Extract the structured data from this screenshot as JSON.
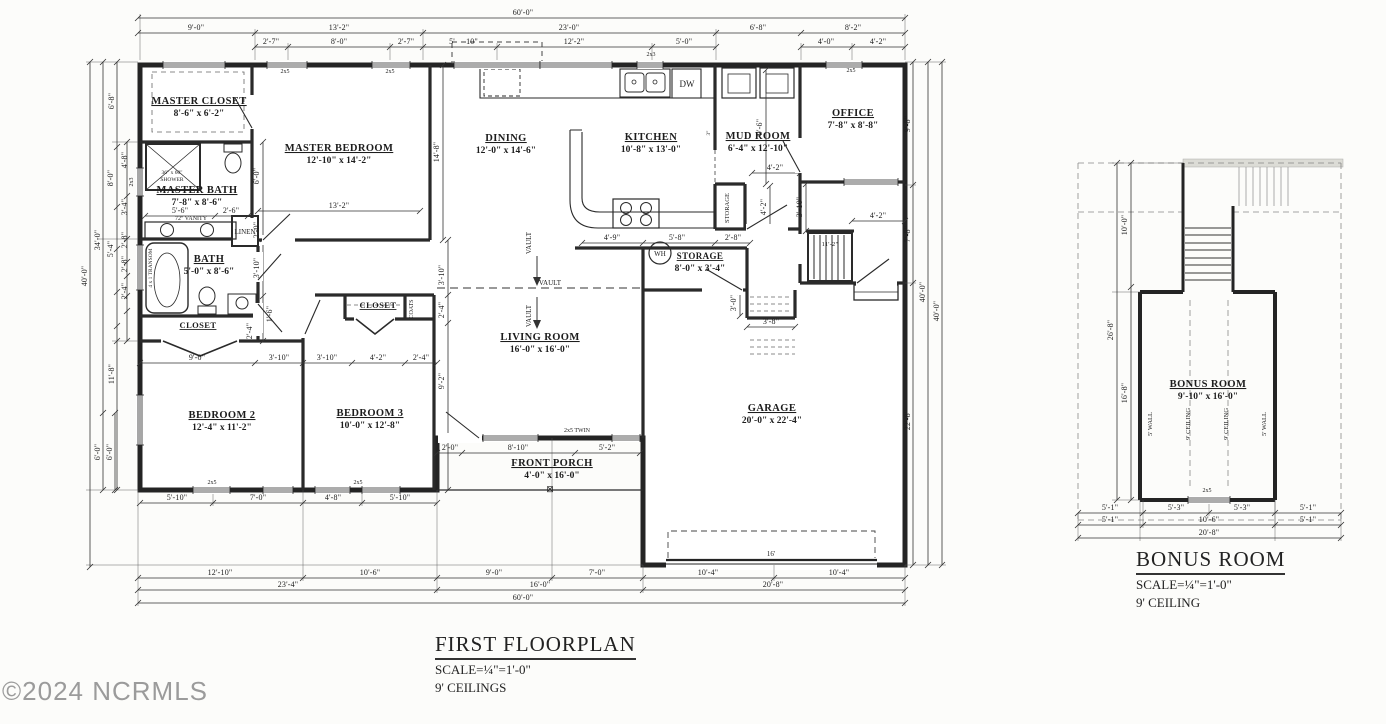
{
  "watermark": {
    "text": "©2024 NCRMLS"
  },
  "first_floor": {
    "title": "FIRST FLOORPLAN",
    "scale": "SCALE=¼\"=1'-0\"",
    "ceiling": "9' CEILINGS"
  },
  "bonus": {
    "title": "BONUS ROOM",
    "scale": "SCALE=¼\"=1'-0\"",
    "ceiling": "9' CEILING"
  },
  "rooms": [
    {
      "n": "MASTER CLOSET",
      "d": "8'-6\" x 6'-2\"",
      "x": 199,
      "y": 104
    },
    {
      "n": "MASTER BEDROOM",
      "d": "12'-10\" x 14'-2\"",
      "x": 339,
      "y": 151
    },
    {
      "n": "MASTER BATH",
      "d": "7'-8\" x 8'-6\"",
      "x": 197,
      "y": 193
    },
    {
      "n": "BATH",
      "d": "5'-0\" x 8'-6\"",
      "x": 209,
      "y": 262
    },
    {
      "n": "CLOSET",
      "x": 198,
      "y": 328,
      "s": 8.5
    },
    {
      "n": "BEDROOM 2",
      "d": "12'-4\" x 11'-2\"",
      "x": 222,
      "y": 418
    },
    {
      "n": "BEDROOM 3",
      "d": "10'-0\" x 12'-8\"",
      "x": 370,
      "y": 416
    },
    {
      "n": "CLOSET",
      "x": 378,
      "y": 308,
      "s": 8.5
    },
    {
      "n": "DINING",
      "d": "12'-0\" x 14'-6\"",
      "x": 506,
      "y": 141
    },
    {
      "n": "KITCHEN",
      "d": "10'-8\" x 13'-0\"",
      "x": 651,
      "y": 140
    },
    {
      "n": "MUD ROOM",
      "d": "6'-4\" x 12'-10\"",
      "x": 758,
      "y": 139
    },
    {
      "n": "OFFICE",
      "d": "7'-8\" x 8'-8\"",
      "x": 853,
      "y": 116
    },
    {
      "n": "LIVING ROOM",
      "d": "16'-0\" x 16'-0\"",
      "x": 540,
      "y": 340
    },
    {
      "n": "STORAGE",
      "d": "8'-0\" x 3'-4\"",
      "x": 700,
      "y": 259,
      "s": 9
    },
    {
      "n": "GARAGE",
      "d": "20'-0\" x 22'-4\"",
      "x": 772,
      "y": 411
    },
    {
      "n": "FRONT PORCH",
      "d": "4'-0\" x 16'-0\"",
      "x": 552,
      "y": 466
    },
    {
      "n": "BONUS ROOM",
      "d": "9'-10\" x 16'-0\"",
      "x": 1208,
      "y": 387
    }
  ],
  "dims": [
    {
      "t": "60'-0\"",
      "x": 523,
      "y": 15
    },
    {
      "t": "9'-0\"",
      "x": 196,
      "y": 30
    },
    {
      "t": "13'-2\"",
      "x": 339,
      "y": 30
    },
    {
      "t": "23'-0\"",
      "x": 569,
      "y": 30
    },
    {
      "t": "6'-8\"",
      "x": 758,
      "y": 30
    },
    {
      "t": "8'-2\"",
      "x": 853,
      "y": 30
    },
    {
      "t": "2'-7\"",
      "x": 271,
      "y": 44
    },
    {
      "t": "8'-0\"",
      "x": 339,
      "y": 44
    },
    {
      "t": "2'-7\"",
      "x": 406,
      "y": 44
    },
    {
      "t": "5'",
      "x": 452,
      "y": 44
    },
    {
      "t": "10\"",
      "x": 472,
      "y": 44
    },
    {
      "t": "12'-2\"",
      "x": 574,
      "y": 44
    },
    {
      "t": "5'-0\"",
      "x": 684,
      "y": 44
    },
    {
      "t": "4'-0\"",
      "x": 826,
      "y": 44
    },
    {
      "t": "4'-2\"",
      "x": 878,
      "y": 44
    },
    {
      "t": "40'-0\"",
      "x": 87,
      "y": 276,
      "r": -90
    },
    {
      "t": "34'-0\"",
      "x": 100,
      "y": 240,
      "r": -90
    },
    {
      "t": "6'-0\"",
      "x": 100,
      "y": 452,
      "r": -90
    },
    {
      "t": "6'-0\"",
      "x": 112,
      "y": 452,
      "r": -90
    },
    {
      "t": "6'-8\"",
      "x": 114,
      "y": 101,
      "r": -90
    },
    {
      "t": "4'-8\"",
      "x": 127,
      "y": 160,
      "r": -90
    },
    {
      "t": "8'-0\"",
      "x": 113,
      "y": 178,
      "r": -90
    },
    {
      "t": "3'-4\"",
      "x": 127,
      "y": 207,
      "r": -90
    },
    {
      "t": "2'-8\"",
      "x": 127,
      "y": 240,
      "r": -90
    },
    {
      "t": "5'-4\"",
      "x": 113,
      "y": 249,
      "r": -90
    },
    {
      "t": "2'-8\"",
      "x": 127,
      "y": 264,
      "r": -90
    },
    {
      "t": "2'-4\"",
      "x": 127,
      "y": 291,
      "r": -90
    },
    {
      "t": "11'-8\"",
      "x": 114,
      "y": 374,
      "r": -90
    },
    {
      "t": "9'-8\"",
      "x": 910,
      "y": 124,
      "r": -90
    },
    {
      "t": "7'-8\"",
      "x": 910,
      "y": 234,
      "r": -90
    },
    {
      "t": "22'-8\"",
      "x": 910,
      "y": 420,
      "r": -90
    },
    {
      "t": "40'-0\"",
      "x": 925,
      "y": 292,
      "r": -90
    },
    {
      "t": "40'-0\"",
      "x": 939,
      "y": 311,
      "r": -90
    },
    {
      "t": "5'-10\"",
      "x": 177,
      "y": 500
    },
    {
      "t": "7'-0\"",
      "x": 258,
      "y": 500
    },
    {
      "t": "4'-8\"",
      "x": 333,
      "y": 500
    },
    {
      "t": "5'-10\"",
      "x": 400,
      "y": 500
    },
    {
      "t": "2'-0\"",
      "x": 450,
      "y": 450
    },
    {
      "t": "8'-10\"",
      "x": 518,
      "y": 450
    },
    {
      "t": "5'-2\"",
      "x": 607,
      "y": 450
    },
    {
      "t": "12'-10\"",
      "x": 220,
      "y": 575
    },
    {
      "t": "10'-6\"",
      "x": 370,
      "y": 575
    },
    {
      "t": "9'-0\"",
      "x": 494,
      "y": 575
    },
    {
      "t": "7'-0\"",
      "x": 597,
      "y": 575
    },
    {
      "t": "10'-4\"",
      "x": 708,
      "y": 575
    },
    {
      "t": "10'-4\"",
      "x": 839,
      "y": 575
    },
    {
      "t": "23'-4\"",
      "x": 288,
      "y": 587
    },
    {
      "t": "16'-0\"",
      "x": 540,
      "y": 587
    },
    {
      "t": "20'-8\"",
      "x": 773,
      "y": 587
    },
    {
      "t": "60'-0\"",
      "x": 523,
      "y": 600
    },
    {
      "t": "13'-2\"",
      "x": 339,
      "y": 208
    },
    {
      "t": "5'-6\"",
      "x": 180,
      "y": 213
    },
    {
      "t": "2'-6\"",
      "x": 231,
      "y": 213
    },
    {
      "t": "6'-0\"",
      "x": 259,
      "y": 176,
      "r": -90
    },
    {
      "t": "2'-0\"",
      "x": 259,
      "y": 230,
      "r": -90
    },
    {
      "t": "3'-10\"",
      "x": 259,
      "y": 268,
      "r": -90
    },
    {
      "t": "1'-6\"",
      "x": 272,
      "y": 314,
      "r": -90
    },
    {
      "t": "2'-4\"",
      "x": 252,
      "y": 331,
      "r": -90
    },
    {
      "t": "9'-0\"",
      "x": 197,
      "y": 360
    },
    {
      "t": "3'-10\"",
      "x": 279,
      "y": 360
    },
    {
      "t": "3'-10\"",
      "x": 327,
      "y": 360
    },
    {
      "t": "4'-2\"",
      "x": 378,
      "y": 360
    },
    {
      "t": "2'-4\"",
      "x": 421,
      "y": 360
    },
    {
      "t": "14'-8\"",
      "x": 439,
      "y": 152,
      "r": -90
    },
    {
      "t": "3'-10\"",
      "x": 444,
      "y": 275,
      "r": -90
    },
    {
      "t": "2'-4\"",
      "x": 444,
      "y": 310,
      "r": -90
    },
    {
      "t": "9'-2\"",
      "x": 444,
      "y": 381,
      "r": -90
    },
    {
      "t": "4'-9\"",
      "x": 612,
      "y": 240
    },
    {
      "t": "5'-8\"",
      "x": 677,
      "y": 240
    },
    {
      "t": "2'-8\"",
      "x": 733,
      "y": 240
    },
    {
      "t": "4'-2\"",
      "x": 775,
      "y": 170
    },
    {
      "t": "4'-2\"",
      "x": 766,
      "y": 207,
      "r": -90
    },
    {
      "t": "3'-10\"",
      "x": 802,
      "y": 207,
      "r": -90
    },
    {
      "t": "9'-6\"",
      "x": 762,
      "y": 127,
      "r": -90
    },
    {
      "t": "4'-2\"",
      "x": 878,
      "y": 218
    },
    {
      "t": "3'-0\"",
      "x": 736,
      "y": 303,
      "r": -90
    },
    {
      "t": "3'-8\"",
      "x": 771,
      "y": 324
    },
    {
      "t": "11'-2\"",
      "x": 830,
      "y": 246,
      "s": 6.5
    },
    {
      "t": "10'-0\"",
      "x": 1127,
      "y": 225,
      "r": -90
    },
    {
      "t": "26'-8\"",
      "x": 1113,
      "y": 330,
      "r": -90
    },
    {
      "t": "16'-8\"",
      "x": 1127,
      "y": 393,
      "r": -90
    },
    {
      "t": "5'-1\"",
      "x": 1110,
      "y": 510
    },
    {
      "t": "5'-3\"",
      "x": 1176,
      "y": 510
    },
    {
      "t": "5'-3\"",
      "x": 1242,
      "y": 510
    },
    {
      "t": "5'-1\"",
      "x": 1308,
      "y": 510
    },
    {
      "t": "5'-1\"",
      "x": 1110,
      "y": 522
    },
    {
      "t": "10'-6\"",
      "x": 1209,
      "y": 522
    },
    {
      "t": "5'-1\"",
      "x": 1308,
      "y": 522
    },
    {
      "t": "20'-8\"",
      "x": 1209,
      "y": 535
    }
  ],
  "annotations": [
    {
      "t": "VAULT",
      "x": 550,
      "y": 285,
      "s": 7
    },
    {
      "t": "VAULT",
      "x": 531,
      "y": 243,
      "r": -90,
      "s": 7
    },
    {
      "t": "VAULT",
      "x": 531,
      "y": 316,
      "r": -90,
      "s": 7
    },
    {
      "t": "2x5",
      "x": 285,
      "y": 73,
      "s": 6
    },
    {
      "t": "2x5",
      "x": 390,
      "y": 73,
      "s": 6
    },
    {
      "t": "2x3",
      "x": 651,
      "y": 56,
      "s": 6
    },
    {
      "t": "2x5",
      "x": 851,
      "y": 72,
      "s": 6
    },
    {
      "t": "2x5",
      "x": 212,
      "y": 484,
      "s": 6
    },
    {
      "t": "2x5",
      "x": 358,
      "y": 484,
      "s": 6
    },
    {
      "t": "2x5 TWIN",
      "x": 577,
      "y": 432,
      "s": 6
    },
    {
      "t": "2x5",
      "x": 1207,
      "y": 492,
      "s": 6
    },
    {
      "t": "2x3",
      "x": 133,
      "y": 182,
      "r": -90,
      "s": 6
    },
    {
      "t": "4 x 1 TRANSOM",
      "x": 152,
      "y": 268,
      "r": -90,
      "s": 5.5
    },
    {
      "t": "36\" x 60\"",
      "x": 172,
      "y": 174,
      "s": 5.5
    },
    {
      "t": "SHOWER",
      "x": 172,
      "y": 181,
      "s": 5.5
    },
    {
      "t": "72\" VANITY",
      "x": 191,
      "y": 220,
      "s": 6
    },
    {
      "t": "LINEN",
      "x": 245,
      "y": 234,
      "s": 7
    },
    {
      "t": "COATS",
      "x": 413,
      "y": 309,
      "r": -90,
      "s": 6
    },
    {
      "t": "STORAGE",
      "x": 729,
      "y": 208,
      "r": -90,
      "s": 6.5
    },
    {
      "t": "WH",
      "x": 660,
      "y": 256,
      "s": 7
    },
    {
      "t": "DW",
      "x": 687,
      "y": 87,
      "s": 9
    },
    {
      "t": "⊠",
      "x": 550,
      "y": 492,
      "s": 9
    },
    {
      "t": "3\"",
      "x": 710,
      "y": 133,
      "r": -90,
      "s": 5.5
    },
    {
      "t": "16'",
      "x": 771,
      "y": 556,
      "s": 7
    },
    {
      "t": "5' WALL",
      "x": 1152,
      "y": 424,
      "r": -90,
      "s": 6.5
    },
    {
      "t": "9' CEILING",
      "x": 1190,
      "y": 424,
      "r": -90,
      "s": 6.5
    },
    {
      "t": "9' CEILING",
      "x": 1228,
      "y": 424,
      "r": -90,
      "s": 6.5
    },
    {
      "t": "5' WALL",
      "x": 1266,
      "y": 424,
      "r": -90,
      "s": 6.5
    }
  ]
}
